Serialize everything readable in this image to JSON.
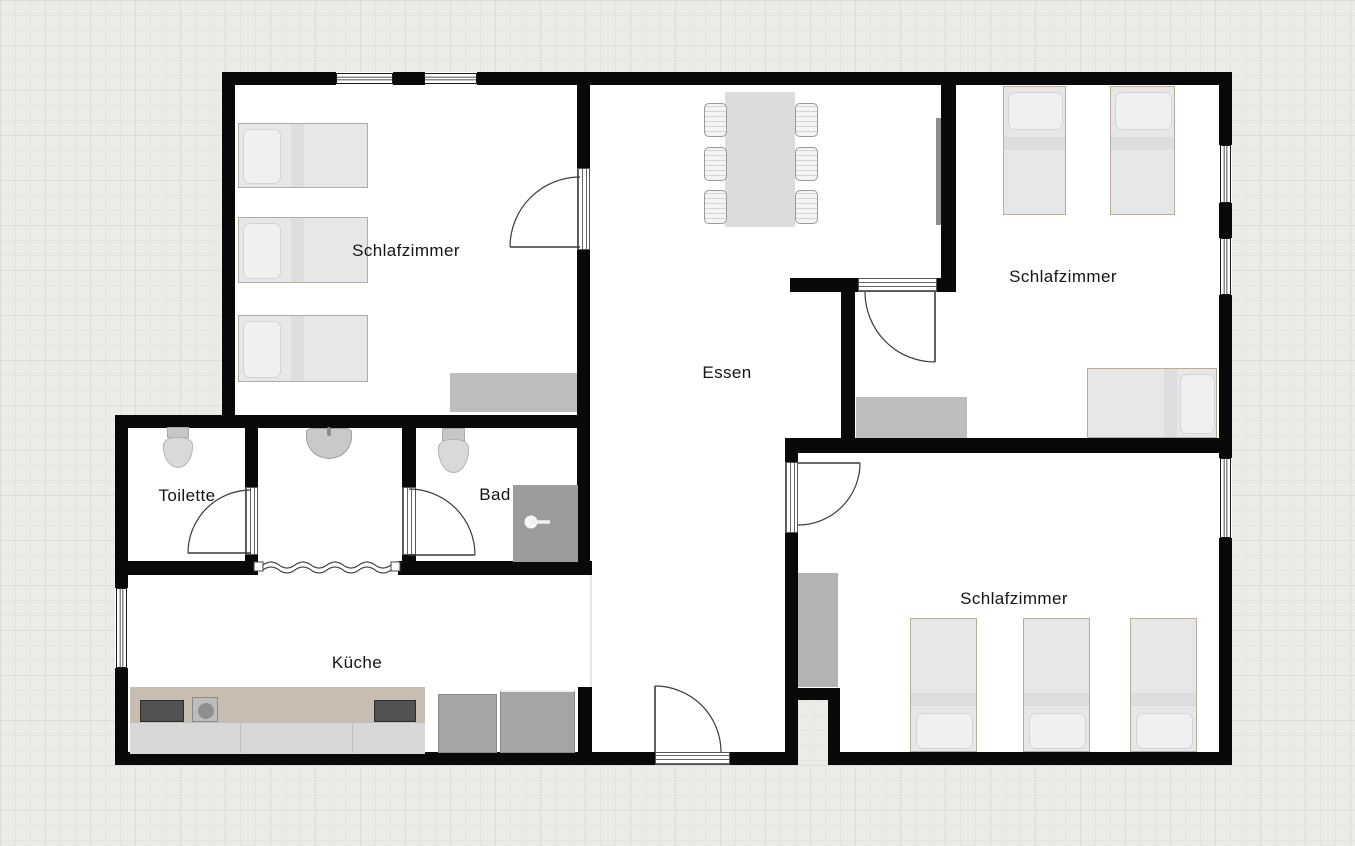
{
  "rooms": [
    {
      "id": "schlafzimmer-1",
      "label": "Schlafzimmer"
    },
    {
      "id": "essen",
      "label": "Essen"
    },
    {
      "id": "schlafzimmer-2",
      "label": "Schlafzimmer"
    },
    {
      "id": "toilette",
      "label": "Toilette"
    },
    {
      "id": "bad",
      "label": "Bad"
    },
    {
      "id": "kueche",
      "label": "Küche"
    },
    {
      "id": "schlafzimmer-3",
      "label": "Schlafzimmer"
    }
  ],
  "colors": {
    "wall": "#090909",
    "floor": "#ffffff",
    "background_grid": "#edebe8",
    "furniture_gray": "#bdbdbd",
    "counter_beige": "#c7bdb1",
    "shower_gray": "#9c9c9c"
  }
}
